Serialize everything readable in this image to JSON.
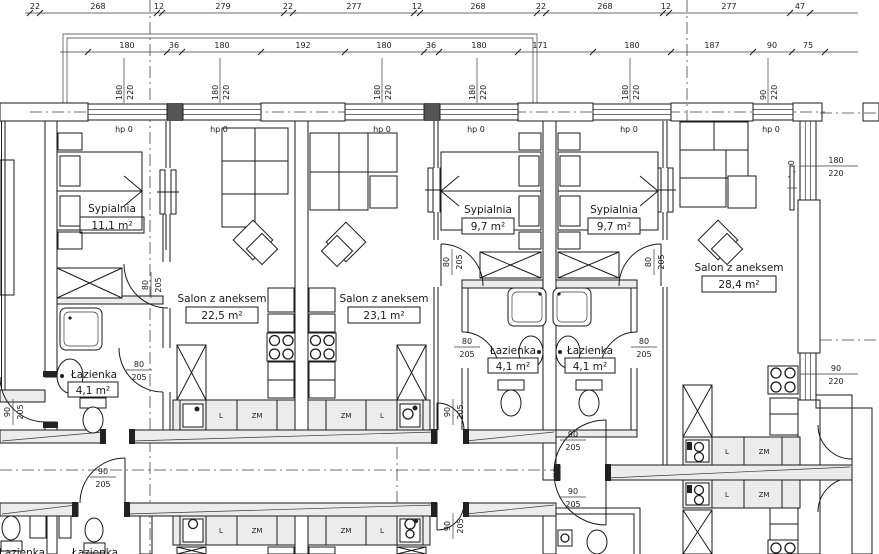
{
  "colors": {
    "ink": "#1a1a1a",
    "paper": "#ffffff",
    "wall_fill": "#ececec"
  },
  "dims": {
    "row1": [
      "22",
      "268",
      "12",
      "279",
      "22",
      "277",
      "12",
      "268",
      "22",
      "268",
      "12",
      "277",
      "47"
    ],
    "row2": [
      "180",
      "36",
      "180",
      "192",
      "180",
      "36",
      "180",
      "171",
      "180",
      "187",
      "90",
      "75"
    ],
    "window_width": "180",
    "window_width_small": "90",
    "window_height": "220",
    "door_width_80": "80",
    "door_width_90": "90",
    "door_height": "205"
  },
  "labels": {
    "window_sill": "hp 0",
    "fridge": "L",
    "dishwasher": "ZM"
  },
  "rooms": {
    "sypialnia_a": {
      "name": "Sypialnia",
      "area": "11,1 m²"
    },
    "salon_a": {
      "name": "Salon z aneksem",
      "area": "22,5 m²"
    },
    "salon_b": {
      "name": "Salon z aneksem",
      "area": "23,1 m²"
    },
    "sypialnia_b": {
      "name": "Sypialnia",
      "area": "9,7 m²"
    },
    "sypialnia_c": {
      "name": "Sypialnia",
      "area": "9,7 m²"
    },
    "salon_c": {
      "name": "Salon z aneksem",
      "area": "28,4 m²"
    },
    "lazienka_a": {
      "name": "Łazienka",
      "area": "4,1 m²"
    },
    "lazienka_b": {
      "name": "Łazienka",
      "area": "4,1 m²"
    },
    "lazienka_c": {
      "name": "Łazienka",
      "area": "4,1 m²"
    },
    "lazienka_lower": {
      "name": "Łazienka"
    }
  }
}
